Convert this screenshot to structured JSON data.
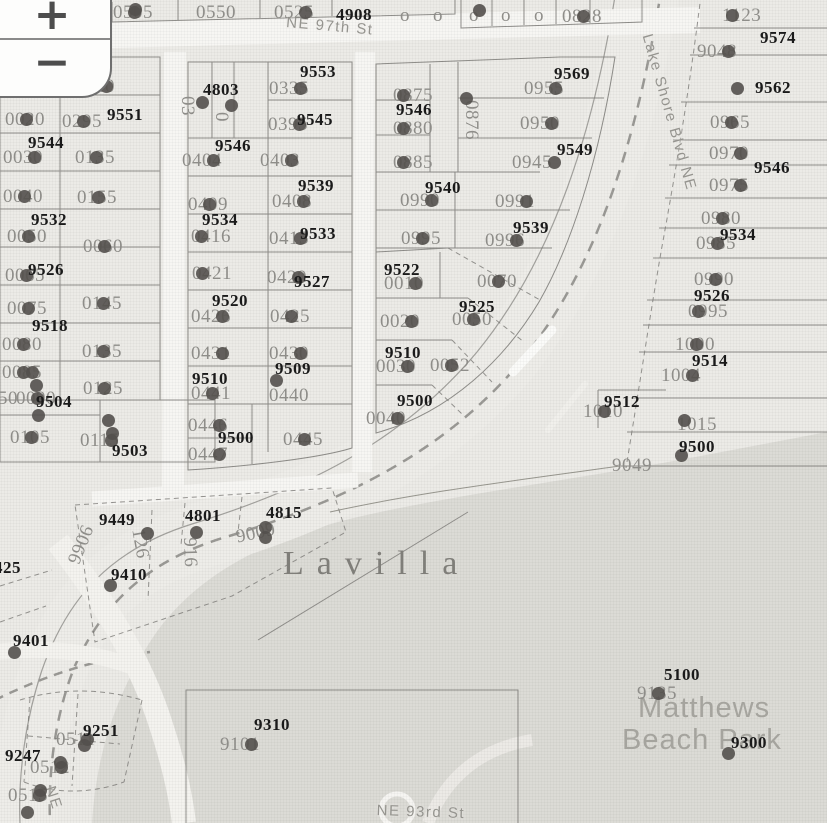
{
  "map": {
    "colors": {
      "base": "#ecebe7",
      "park_fill": "#dcdbd6",
      "road_white": "#f7f6f3",
      "marker": "#53504d",
      "address_text": "#1a1a1a",
      "lot_text": "#8e8d89"
    },
    "zoom_control": {
      "zoom_in": "+",
      "zoom_out": "−"
    },
    "place_labels": [
      {
        "t": "Lavilla",
        "x": 283,
        "y": 545,
        "style": "serif"
      },
      {
        "t": "Matthews",
        "x": 638,
        "y": 692,
        "style": "park"
      },
      {
        "t": "Beach Park",
        "x": 622,
        "y": 724,
        "style": "park"
      }
    ],
    "street_labels": [
      {
        "t": "NE 97th St",
        "x": 287,
        "y": 14,
        "r": 5
      },
      {
        "t": "Lake Shore Blvd NE",
        "x": 655,
        "y": 32,
        "r": 74
      },
      {
        "t": "NE 93rd St",
        "x": 377,
        "y": 802,
        "r": 2
      },
      {
        "t": "NE",
        "x": 58,
        "y": 784,
        "r": 72
      }
    ],
    "address_labels": [
      {
        "t": "4908",
        "x": 336,
        "y": 5
      },
      {
        "t": "9552",
        "x": 27,
        "y": 56
      },
      {
        "t": "9553",
        "x": 300,
        "y": 62
      },
      {
        "t": "4803",
        "x": 203,
        "y": 80
      },
      {
        "t": "9551",
        "x": 107,
        "y": 105
      },
      {
        "t": "9545",
        "x": 297,
        "y": 110
      },
      {
        "t": "9544",
        "x": 28,
        "y": 133
      },
      {
        "t": "9546",
        "x": 215,
        "y": 136
      },
      {
        "t": "9569",
        "x": 554,
        "y": 64
      },
      {
        "t": "9546",
        "x": 396,
        "y": 100
      },
      {
        "t": "9549",
        "x": 557,
        "y": 140
      },
      {
        "t": "9539",
        "x": 298,
        "y": 176
      },
      {
        "t": "9540",
        "x": 425,
        "y": 178
      },
      {
        "t": "9534",
        "x": 202,
        "y": 210
      },
      {
        "t": "9533",
        "x": 300,
        "y": 224
      },
      {
        "t": "9532",
        "x": 31,
        "y": 210
      },
      {
        "t": "9539",
        "x": 513,
        "y": 218
      },
      {
        "t": "9522",
        "x": 384,
        "y": 260
      },
      {
        "t": "9526",
        "x": 28,
        "y": 260
      },
      {
        "t": "9527",
        "x": 294,
        "y": 272
      },
      {
        "t": "9520",
        "x": 212,
        "y": 291
      },
      {
        "t": "9525",
        "x": 459,
        "y": 297
      },
      {
        "t": "9518",
        "x": 32,
        "y": 316
      },
      {
        "t": "9510",
        "x": 192,
        "y": 369
      },
      {
        "t": "9509",
        "x": 275,
        "y": 359
      },
      {
        "t": "9510",
        "x": 385,
        "y": 343
      },
      {
        "t": "9504",
        "x": 36,
        "y": 392
      },
      {
        "t": "9500",
        "x": 397,
        "y": 391
      },
      {
        "t": "9500",
        "x": 218,
        "y": 428
      },
      {
        "t": "9503",
        "x": 112,
        "y": 441
      },
      {
        "t": "9574",
        "x": 760,
        "y": 28
      },
      {
        "t": "9562",
        "x": 755,
        "y": 78
      },
      {
        "t": "9546",
        "x": 754,
        "y": 158
      },
      {
        "t": "9534",
        "x": 720,
        "y": 225
      },
      {
        "t": "9526",
        "x": 694,
        "y": 286
      },
      {
        "t": "9514",
        "x": 692,
        "y": 351
      },
      {
        "t": "9512",
        "x": 604,
        "y": 392
      },
      {
        "t": "9500",
        "x": 679,
        "y": 437
      },
      {
        "t": "5100",
        "x": 664,
        "y": 665
      },
      {
        "t": "9300",
        "x": 731,
        "y": 733
      },
      {
        "t": "9449",
        "x": 99,
        "y": 510
      },
      {
        "t": "4801",
        "x": 185,
        "y": 506
      },
      {
        "t": "4815",
        "x": 266,
        "y": 503
      },
      {
        "t": "9410",
        "x": 111,
        "y": 565
      },
      {
        "t": "9401",
        "x": 13,
        "y": 631
      },
      {
        "t": "425",
        "x": -6,
        "y": 558
      },
      {
        "t": "9251",
        "x": 83,
        "y": 721
      },
      {
        "t": "9247",
        "x": 5,
        "y": 746
      },
      {
        "t": "9310",
        "x": 254,
        "y": 715
      }
    ],
    "lot_labels": [
      {
        "t": "0505",
        "x": 113,
        "y": 2,
        "d": 1
      },
      {
        "t": "0550",
        "x": 196,
        "y": 2
      },
      {
        "t": "0525",
        "x": 274,
        "y": 2,
        "d": 2
      },
      {
        "t": "o",
        "x": 400,
        "y": 5
      },
      {
        "t": "o",
        "x": 433,
        "y": 5
      },
      {
        "t": "o",
        "x": 469,
        "y": 5
      },
      {
        "t": "o",
        "x": 501,
        "y": 5
      },
      {
        "t": "o",
        "x": 534,
        "y": 5
      },
      {
        "t": "0828",
        "x": 562,
        "y": 6,
        "d": 1
      },
      {
        "t": "0200",
        "x": 3,
        "y": 75,
        "d": 0
      },
      {
        "t": "0240",
        "x": 75,
        "y": 76,
        "d": 2
      },
      {
        "t": "0020",
        "x": 5,
        "y": 109,
        "d": 1
      },
      {
        "t": "0295",
        "x": 62,
        "y": 111,
        "d": 1
      },
      {
        "t": "0030",
        "x": 3,
        "y": 147,
        "d": 2
      },
      {
        "t": "0135",
        "x": 75,
        "y": 147,
        "d": 1
      },
      {
        "t": "0040",
        "x": 3,
        "y": 186,
        "d": 1
      },
      {
        "t": "0155",
        "x": 77,
        "y": 187,
        "d": 1
      },
      {
        "t": "0050",
        "x": 7,
        "y": 226,
        "d": 1
      },
      {
        "t": "0060",
        "x": 83,
        "y": 236,
        "d": 1
      },
      {
        "t": "0065",
        "x": 5,
        "y": 265,
        "d": 1
      },
      {
        "t": "0075",
        "x": 7,
        "y": 298,
        "d": 1
      },
      {
        "t": "0145",
        "x": 82,
        "y": 293,
        "d": 1
      },
      {
        "t": "0080",
        "x": 2,
        "y": 334,
        "d": 1
      },
      {
        "t": "0135",
        "x": 82,
        "y": 341,
        "d": 1
      },
      {
        "t": "0085",
        "x": 2,
        "y": 362,
        "d": 1
      },
      {
        "t": "0125",
        "x": 83,
        "y": 378,
        "d": 1
      },
      {
        "t": "50",
        "x": -2,
        "y": 388
      },
      {
        "t": "0090",
        "x": 16,
        "y": 388,
        "d": 1
      },
      {
        "t": "0105",
        "x": 10,
        "y": 427,
        "d": 1
      },
      {
        "t": "0115",
        "x": 80,
        "y": 430,
        "d": 2
      },
      {
        "t": "03",
        "x": 198,
        "y": 96,
        "r": 90
      },
      {
        "t": "0",
        "x": 232,
        "y": 112,
        "r": 90
      },
      {
        "t": "0335",
        "x": 269,
        "y": 78,
        "d": 2
      },
      {
        "t": "0395",
        "x": 268,
        "y": 114,
        "d": 2
      },
      {
        "t": "0404",
        "x": 182,
        "y": 150,
        "d": 2
      },
      {
        "t": "0403",
        "x": 260,
        "y": 150,
        "d": 2
      },
      {
        "t": "0409",
        "x": 188,
        "y": 194,
        "d": 1
      },
      {
        "t": "0408",
        "x": 272,
        "y": 191,
        "d": 2
      },
      {
        "t": "0416",
        "x": 191,
        "y": 226,
        "d": 0
      },
      {
        "t": "0415",
        "x": 269,
        "y": 228,
        "d": 2
      },
      {
        "t": "0421",
        "x": 192,
        "y": 263,
        "d": 0
      },
      {
        "t": "0420",
        "x": 267,
        "y": 267,
        "d": 2
      },
      {
        "t": "0426",
        "x": 191,
        "y": 306,
        "d": 2
      },
      {
        "t": "0425",
        "x": 270,
        "y": 306,
        "d": 1
      },
      {
        "t": "0431",
        "x": 191,
        "y": 343,
        "d": 2
      },
      {
        "t": "0430",
        "x": 269,
        "y": 343,
        "d": 2
      },
      {
        "t": "0441",
        "x": 191,
        "y": 383,
        "d": 1
      },
      {
        "t": "0440",
        "x": 269,
        "y": 385
      },
      {
        "t": "0446",
        "x": 188,
        "y": 415,
        "d": 2
      },
      {
        "t": "0445",
        "x": 283,
        "y": 429,
        "d": 1
      },
      {
        "t": "0447",
        "x": 188,
        "y": 444,
        "d": 2
      },
      {
        "t": "0875",
        "x": 393,
        "y": 85,
        "d": 0
      },
      {
        "t": "0880",
        "x": 393,
        "y": 118,
        "d": 0
      },
      {
        "t": "0885",
        "x": 393,
        "y": 152,
        "d": 0
      },
      {
        "t": "0876",
        "x": 482,
        "y": 100,
        "r": 90
      },
      {
        "t": "0955",
        "x": 524,
        "y": 78,
        "d": 2
      },
      {
        "t": "0950",
        "x": 520,
        "y": 113,
        "d": 2
      },
      {
        "t": "0945",
        "x": 512,
        "y": 152,
        "d": 3
      },
      {
        "t": "0990",
        "x": 400,
        "y": 190,
        "d": 2
      },
      {
        "t": "0991",
        "x": 495,
        "y": 191,
        "d": 2
      },
      {
        "t": "0995",
        "x": 401,
        "y": 228,
        "d": 1
      },
      {
        "t": "0996",
        "x": 485,
        "y": 230,
        "d": 2
      },
      {
        "t": "0010",
        "x": 384,
        "y": 273,
        "d": 2
      },
      {
        "t": "0070",
        "x": 477,
        "y": 271,
        "d": 1
      },
      {
        "t": "0020",
        "x": 380,
        "y": 311,
        "d": 2
      },
      {
        "t": "0050",
        "x": 452,
        "y": 309,
        "d": 1
      },
      {
        "t": "0030",
        "x": 376,
        "y": 356,
        "d": 2
      },
      {
        "t": "0052",
        "x": 430,
        "y": 355,
        "d": 1
      },
      {
        "t": "0040",
        "x": 366,
        "y": 408,
        "d": 2
      },
      {
        "t": "1123",
        "x": 722,
        "y": 5,
        "d": 0
      },
      {
        "t": "9048",
        "x": 697,
        "y": 41,
        "d": 2
      },
      {
        "t": "0965",
        "x": 710,
        "y": 112,
        "d": 1
      },
      {
        "t": "0970",
        "x": 709,
        "y": 143,
        "d": 2
      },
      {
        "t": "0975",
        "x": 709,
        "y": 175,
        "d": 2
      },
      {
        "t": "0980",
        "x": 701,
        "y": 208,
        "d": 1
      },
      {
        "t": "0985",
        "x": 696,
        "y": 233,
        "d": 1
      },
      {
        "t": "0990",
        "x": 694,
        "y": 269,
        "d": 1
      },
      {
        "t": "0995",
        "x": 688,
        "y": 301,
        "d": 0
      },
      {
        "t": "1000",
        "x": 675,
        "y": 334,
        "d": 1
      },
      {
        "t": "1004",
        "x": 661,
        "y": 365,
        "d": 2
      },
      {
        "t": "1010",
        "x": 583,
        "y": 401,
        "d": 1
      },
      {
        "t": "1015",
        "x": 677,
        "y": 414
      },
      {
        "t": "9049",
        "x": 612,
        "y": 455
      },
      {
        "t": "9066",
        "x": 97,
        "y": 530,
        "r": 112
      },
      {
        "t": "126",
        "x": 148,
        "y": 527,
        "r": 80
      },
      {
        "t": "916",
        "x": 200,
        "y": 537,
        "r": 88
      },
      {
        "t": "9009",
        "x": 234,
        "y": 527,
        "r": -12,
        "d": 2
      },
      {
        "t": "9101",
        "x": 220,
        "y": 734,
        "d": 2
      },
      {
        "t": "0511",
        "x": 56,
        "y": 729,
        "d": 2
      },
      {
        "t": "0512",
        "x": 30,
        "y": 757,
        "d": 2
      },
      {
        "t": "0515",
        "x": 8,
        "y": 785,
        "d": 2
      },
      {
        "t": "9135",
        "x": 637,
        "y": 683,
        "d": 1
      }
    ],
    "markers": [
      [
        135,
        9
      ],
      [
        479,
        10
      ],
      [
        202,
        102
      ],
      [
        231,
        105
      ],
      [
        466,
        98
      ],
      [
        737,
        88
      ],
      [
        684,
        420
      ],
      [
        681,
        455
      ],
      [
        147,
        533
      ],
      [
        196,
        532
      ],
      [
        265,
        527
      ],
      [
        110,
        585
      ],
      [
        14,
        652
      ],
      [
        84,
        745
      ],
      [
        60,
        762
      ],
      [
        40,
        790
      ],
      [
        27,
        812
      ],
      [
        728,
        753
      ],
      [
        276,
        380
      ],
      [
        108,
        420
      ],
      [
        112,
        433
      ],
      [
        32,
        372
      ],
      [
        36,
        385
      ],
      [
        38,
        415
      ]
    ]
  }
}
